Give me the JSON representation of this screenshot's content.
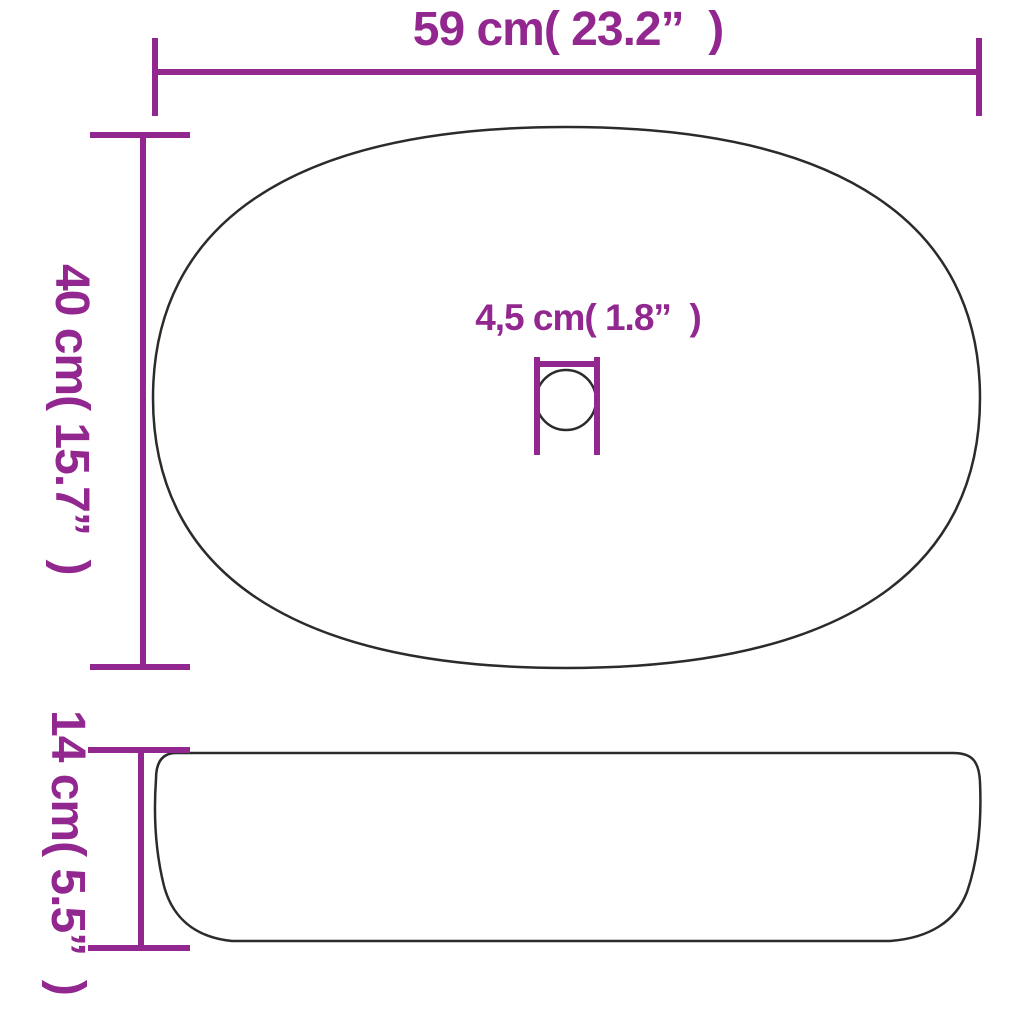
{
  "page": {
    "title": "Oval basin dimension diagram",
    "background_color": "#ffffff",
    "accent_color": "#92278F",
    "outline_color": "#2b2b2b"
  },
  "top_view": {
    "width_label": "59 cm( 23.2”  )",
    "depth_label": "40 cm( 15.7”  )",
    "drain_label": "4,5 cm( 1.8”  )"
  },
  "side_view": {
    "height_label": "14 cm( 5.5”  )"
  }
}
